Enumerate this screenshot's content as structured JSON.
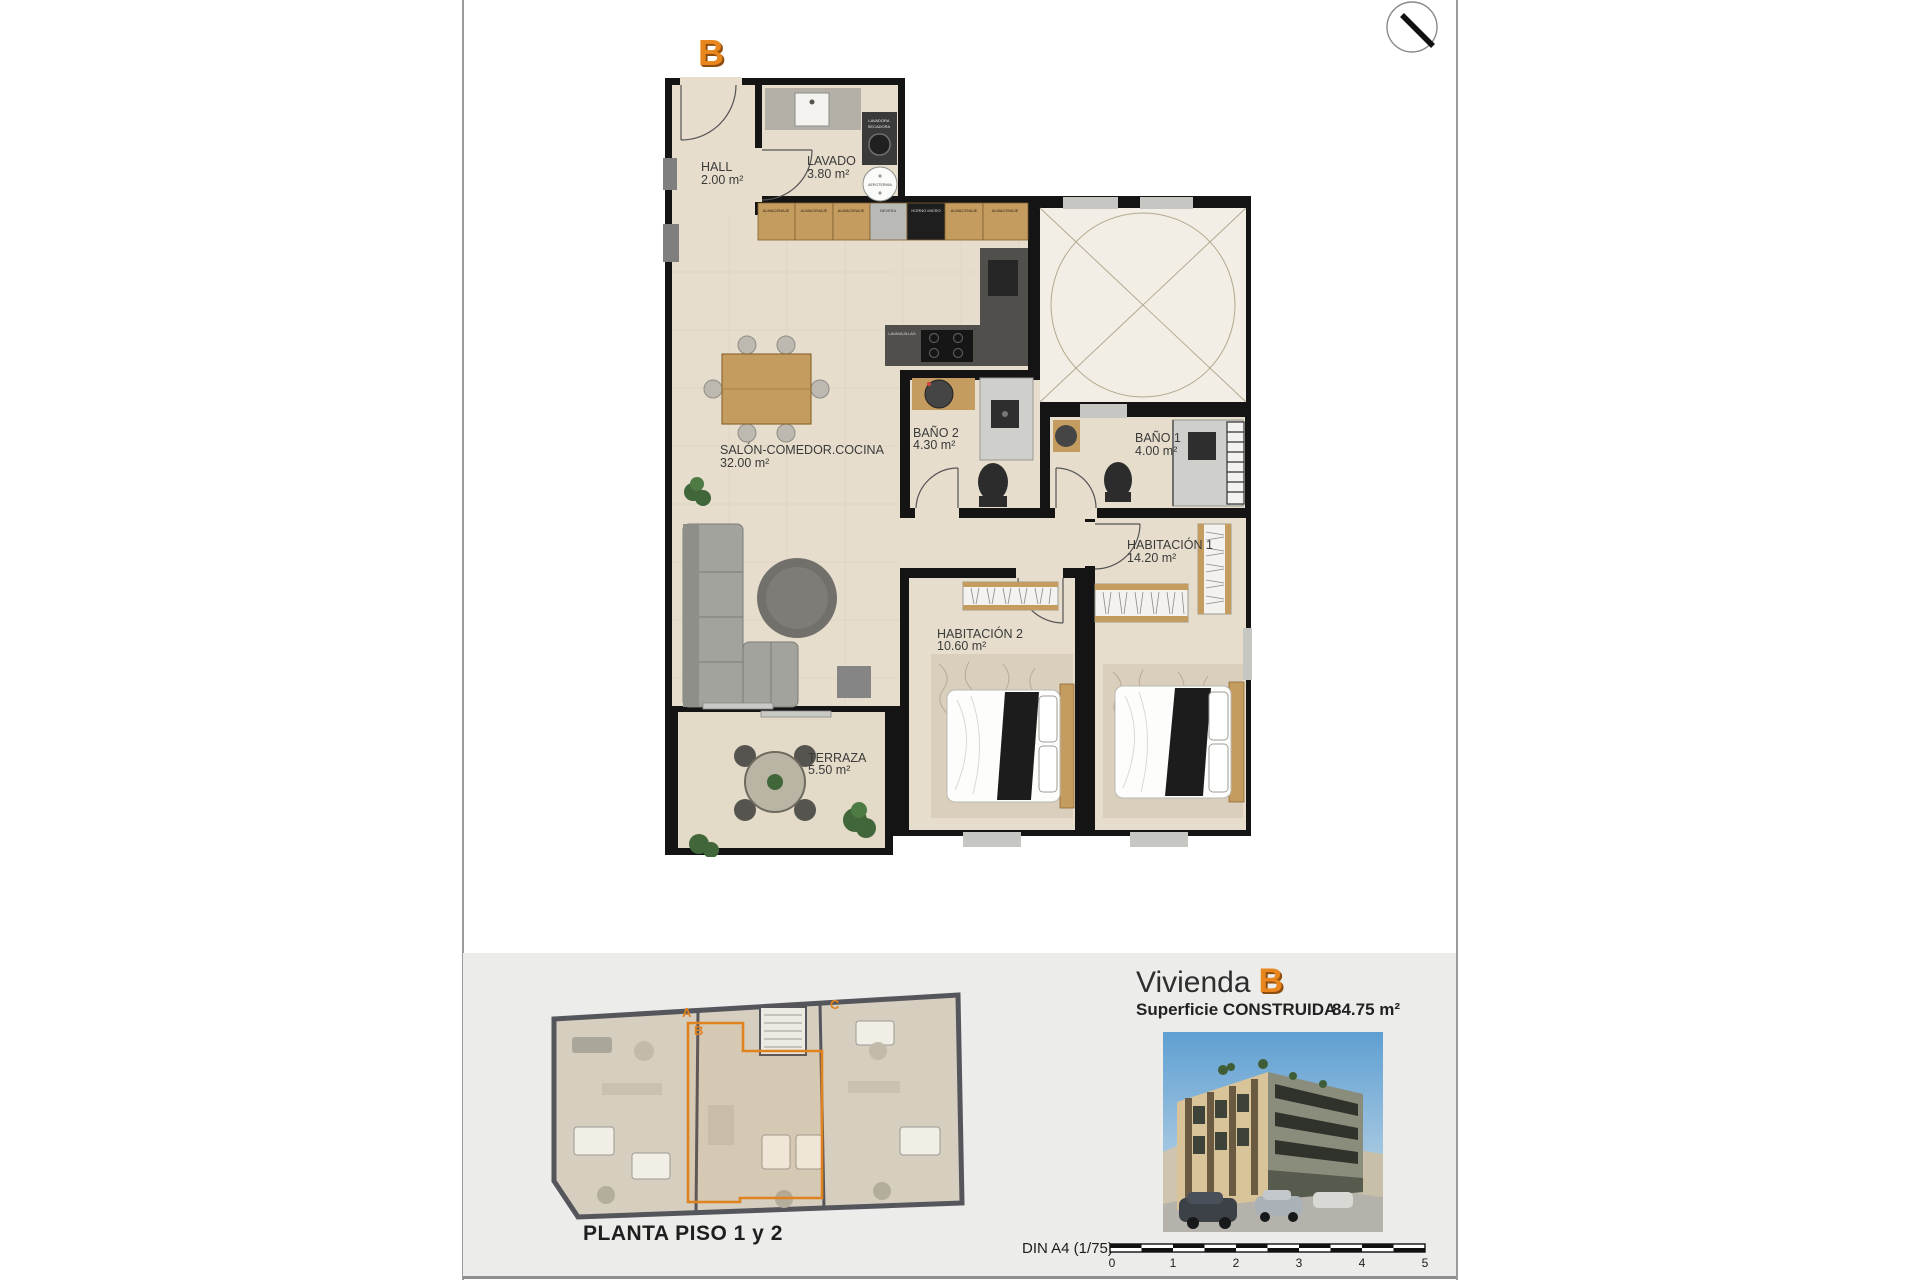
{
  "page": {
    "unit_badge": "B"
  },
  "floor_plan": {
    "rooms": [
      {
        "name": "HALL",
        "area": "2.00 m²"
      },
      {
        "name": "LAVADO",
        "area": "3.80 m²"
      },
      {
        "name": "SALÓN-COMEDOR.COCINA",
        "area": "32.00 m²"
      },
      {
        "name": "BAÑO 2",
        "area": "4.30 m²"
      },
      {
        "name": "BAÑO 1",
        "area": "4.00 m²"
      },
      {
        "name": "HABITACIÓN 1",
        "area": "14.20 m²"
      },
      {
        "name": "HABITACIÓN 2",
        "area": "10.60 m²"
      },
      {
        "name": "TERRAZA",
        "area": "5.50 m²"
      }
    ],
    "kitchen_units": [
      "ALMACENAJE",
      "ALMACENAJE",
      "ALMACENAJE",
      "NEVERA",
      "HORNO MICRO",
      "ALMACENAJE",
      "ALMACENAJE"
    ],
    "appliances": {
      "washer_line1": "LAVADORA",
      "washer_line2": "SECADORA",
      "aerotermia": "AEROTERMIA",
      "dishwasher": "LAVAVAJILLAS"
    }
  },
  "footer": {
    "overview_caption": "PLANTA PISO 1 y 2",
    "units": [
      "A",
      "B",
      "C"
    ],
    "title_word": "Vivienda",
    "title_letter": "B",
    "surface_label": "Superficie CONSTRUIDA",
    "surface_value": "84.75 m²",
    "scale_label": "DIN A4 (1/75)",
    "scale_ticks": [
      "0",
      "1",
      "2",
      "3",
      "4",
      "5"
    ]
  },
  "colors": {
    "accent_orange": "#e8861d",
    "wall_black": "#141414",
    "floor_beige": "#e6ddcc",
    "footer_gray": "#ececea"
  }
}
